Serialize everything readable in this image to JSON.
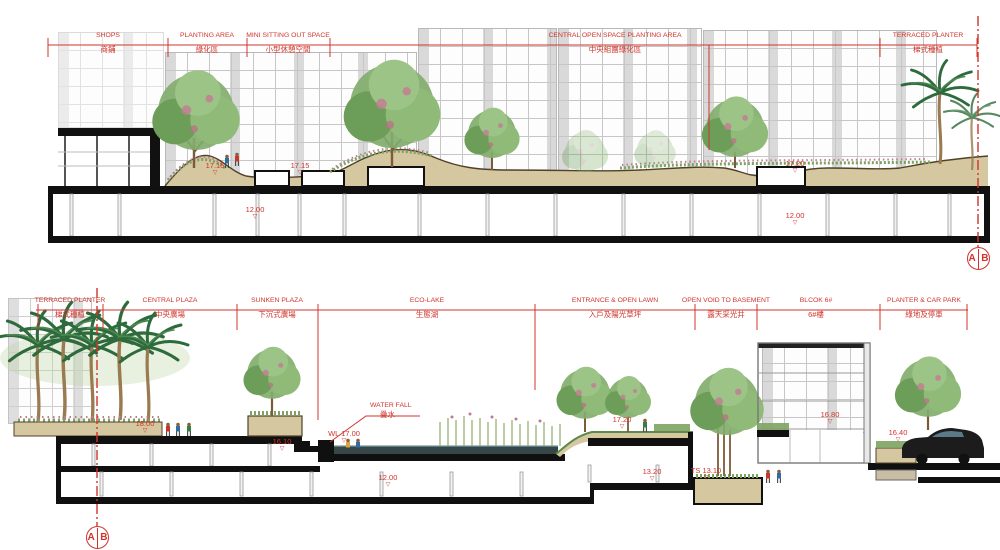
{
  "colors": {
    "annotation_red": "#d0342c",
    "earth_tan": "#d5c79f",
    "structure_black": "#101010",
    "water_dark": "#36474a",
    "tree_green": "#82ad6c",
    "palm_green": "#2e6b3c"
  },
  "top_section": {
    "zones": [
      {
        "en": "SHOPS",
        "zh": "商鋪"
      },
      {
        "en": "PLANTING AREA",
        "zh": "綠化區"
      },
      {
        "en": "MINI SITTING OUT SPACE",
        "zh": "小型休憩空間"
      },
      {
        "en": "CENTRAL OPEN SPACE PLANTING AREA",
        "zh": "中央組團綠化區"
      },
      {
        "en": "TERRACED PLANTER",
        "zh": "梯式種植"
      }
    ],
    "levels": [
      "17.15",
      "17.15",
      "12.00",
      "17.20",
      "12.00"
    ],
    "marker": {
      "left": "A",
      "right": "B"
    }
  },
  "bottom_section": {
    "zones": [
      {
        "en": "TERRACED PLANTER",
        "zh": "梯式種植"
      },
      {
        "en": "CENTRAL PLAZA",
        "zh": "中央廣場"
      },
      {
        "en": "SUNKEN PLAZA",
        "zh": "下沉式廣場"
      },
      {
        "en": "ECO-LAKE",
        "zh": "生態湖"
      },
      {
        "en": "ENTRANCE & OPEN LAWN",
        "zh": "入戶及陽光草坪"
      },
      {
        "en": "OPEN VOID TO BASEMENT",
        "zh": "露天采光井"
      },
      {
        "en": "BLCOK 6#",
        "zh": "6#樓"
      },
      {
        "en": "PLANTER & CAR PARK",
        "zh": "綠地及停車"
      }
    ],
    "levels": [
      "18.00",
      "16.10",
      "WL 17.00",
      "12.00",
      "17.20",
      "13.20",
      "TS 13.10",
      "16.80",
      "16.40"
    ],
    "waterfall": {
      "en": "WATER FALL",
      "zh": "疊水"
    },
    "marker": {
      "left": "A",
      "right": "B"
    }
  }
}
